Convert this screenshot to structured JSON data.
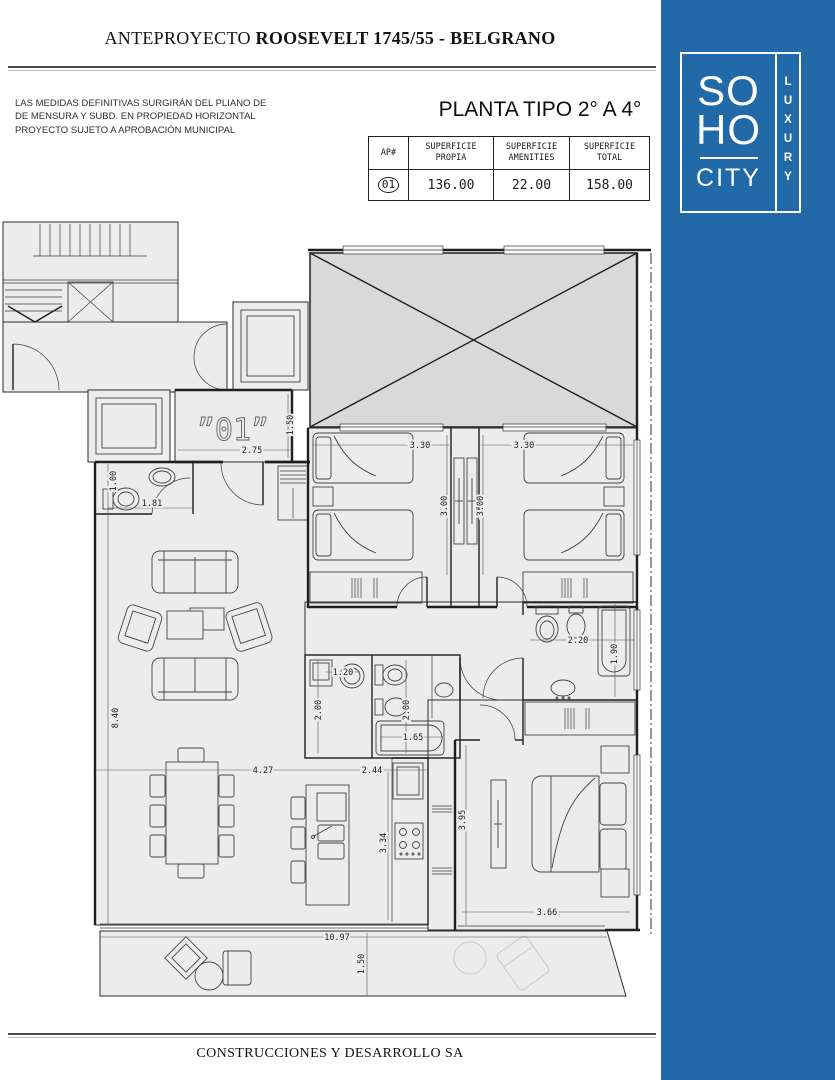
{
  "header": {
    "title_regular": "ANTEPROYECTO ",
    "title_bold": "ROOSEVELT 1745/55 - BELGRANO"
  },
  "disclaimer": {
    "line1": "LAS MEDIDAS DEFINITIVAS SURGIRÁN DEL PLIANO DE",
    "line2": "DE MENSURA Y SUBD. EN PROPIEDAD HORIZONTAL",
    "line3": "PROYECTO SUJETO A APROBACIÓN MUNICIPAL"
  },
  "plan_title": "PLANTA TIPO 2° A 4°",
  "table": {
    "headers": [
      "AP#",
      "SUPERFICIE\nPROPIA",
      "SUPERFICIE\nAMENITIES",
      "SUPERFICIE\nTOTAL"
    ],
    "row": {
      "ap": "01",
      "propia": "136.00",
      "amenities": "22.00",
      "total": "158.00"
    }
  },
  "logo": {
    "line1": "SO",
    "line2": "HO",
    "line3": "CITY",
    "vertical": "LUXURY",
    "brand_blue": "#2269A8"
  },
  "footer": {
    "company": "CONSTRUCCIONES Y DESARROLLO SA"
  },
  "plan": {
    "unit_label": "”01”",
    "dims": {
      "entry_w": "2.75",
      "entry_h": "1.50",
      "bed1_w": "3.30",
      "bed2_w": "3.30",
      "bed1_d": "3.00",
      "bed2_d": "3.00",
      "wc_d": "1.00",
      "wc_w": "1.81",
      "living_d": "8.40",
      "laundry_w": "1.20",
      "laundry_d": "2.00",
      "bath_d": "2.00",
      "tub_w": "1.65",
      "dining_w": "4.27",
      "kitchen_w": "2.44",
      "ensuite_w": "2.20",
      "ensuite_tub_d": "1.90",
      "kitchen_d": "3.34",
      "master_d": "3.95",
      "master_w": "3.66",
      "balcony_w": "10.97",
      "balcony_d": "1.50"
    }
  }
}
